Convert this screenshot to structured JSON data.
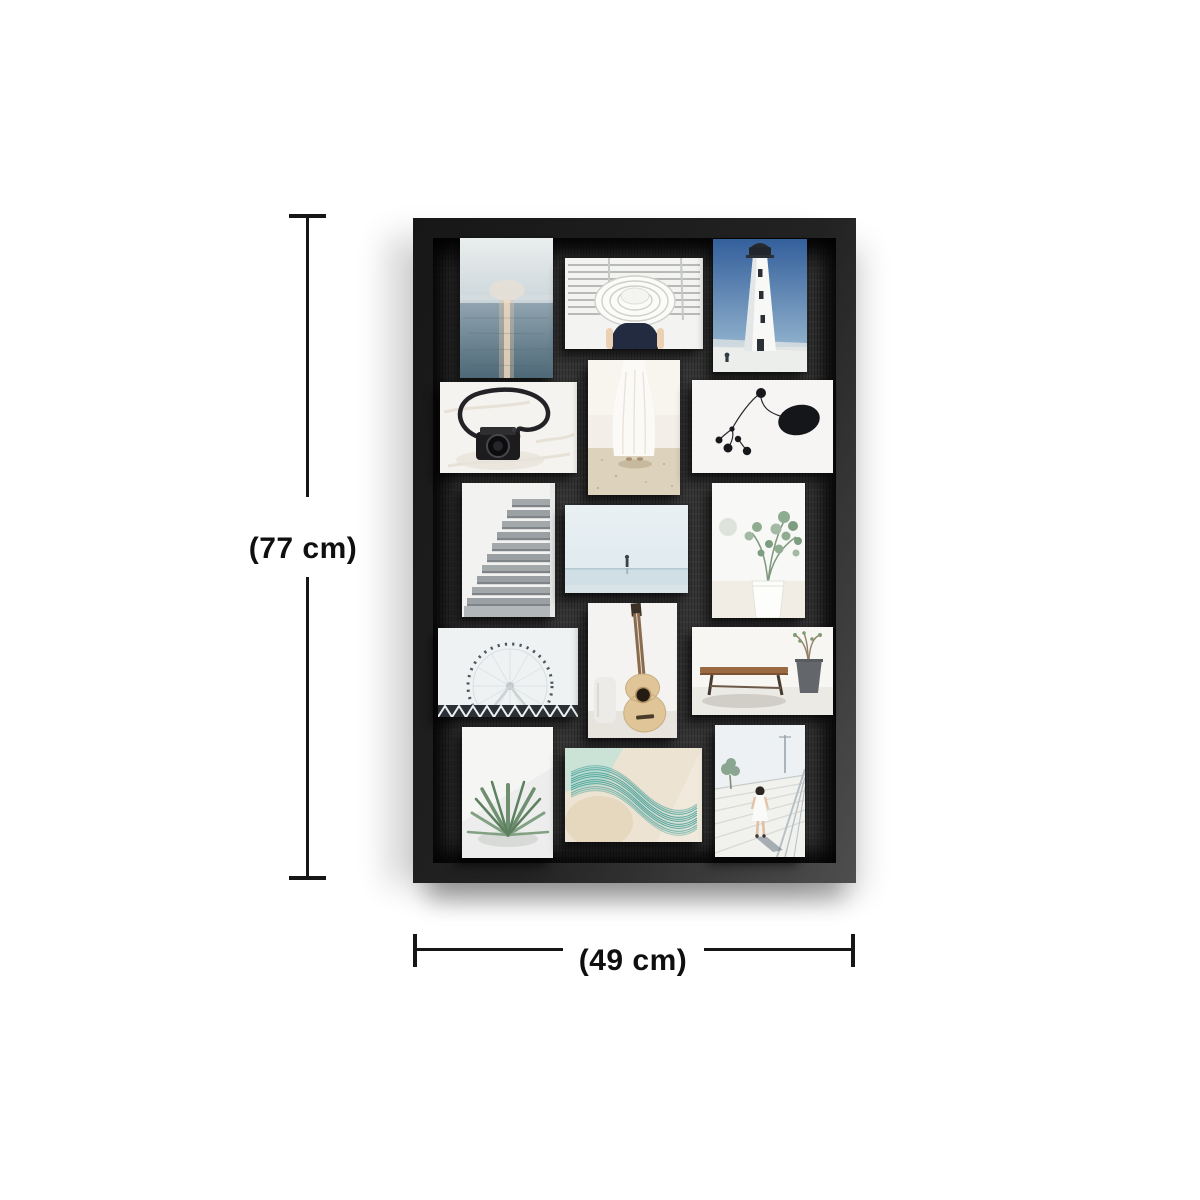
{
  "annotations": {
    "height_label": "(77 cm)",
    "width_label": "(49 cm)"
  },
  "frame": {
    "name": "15-opening black collage photo frame",
    "frame_color": "#222222",
    "backboard_color": "#353535",
    "photo_count": "15",
    "photos": [
      {
        "id": "ocean-sunset",
        "orientation": "portrait",
        "description": "sunset light reflecting on a calm sea"
      },
      {
        "id": "sun-hat",
        "orientation": "landscape",
        "description": "woman in wide-brim white hat in front of louvered shutters"
      },
      {
        "id": "lighthouse",
        "orientation": "portrait",
        "description": "white lighthouse against deep blue sky"
      },
      {
        "id": "camera",
        "orientation": "landscape",
        "description": "camera with looped strap on white bedding"
      },
      {
        "id": "white-dress",
        "orientation": "portrait",
        "description": "woman in white dress standing on sand"
      },
      {
        "id": "mobile-art",
        "orientation": "landscape",
        "description": "abstract black mobile sculpture with dots"
      },
      {
        "id": "stairs",
        "orientation": "portrait",
        "description": "light concrete staircase"
      },
      {
        "id": "calm-beach",
        "orientation": "landscape",
        "description": "lone figure on a pale shoreline"
      },
      {
        "id": "eucalyptus",
        "orientation": "portrait",
        "description": "eucalyptus sprigs in a white vase"
      },
      {
        "id": "ferris-wheel",
        "orientation": "landscape",
        "description": "white ferris wheel above a dark truss bridge"
      },
      {
        "id": "guitar",
        "orientation": "portrait",
        "description": "acoustic guitar leaning on a white wall"
      },
      {
        "id": "bench",
        "orientation": "landscape",
        "description": "wooden bench and potted plant"
      },
      {
        "id": "agave",
        "orientation": "portrait",
        "description": "green agave plant on white stone"
      },
      {
        "id": "wave-art",
        "orientation": "landscape",
        "description": "teal line-wave abstract print"
      },
      {
        "id": "boardwalk-child",
        "orientation": "portrait",
        "description": "child walking away on a white boardwalk"
      }
    ]
  },
  "colors": {
    "dimension_lines": "#161616",
    "background": "#ffffff"
  }
}
